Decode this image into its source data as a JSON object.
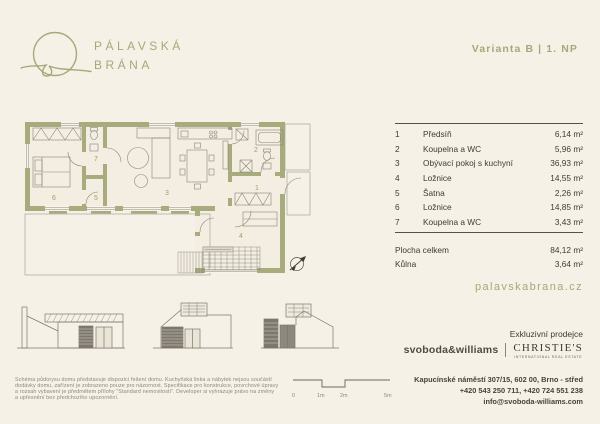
{
  "colors": {
    "background": "#f6f1e7",
    "olive_accent": "#a6a878",
    "wall_olive": "#a8ab7c",
    "ink": "#3e3b32",
    "muted_gray": "#8a857a"
  },
  "brand": {
    "line1": "PÁLAVSKÁ",
    "line2": "BRÁNA",
    "variant": "Varianta B | 1. NP",
    "website": "palavskabrana.cz"
  },
  "rooms": [
    {
      "num": "1",
      "label": "Předsíň",
      "area": "6,14 m²"
    },
    {
      "num": "2",
      "label": "Koupelna a WC",
      "area": "5,96 m²"
    },
    {
      "num": "3",
      "label": "Obývací pokoj s kuchyní",
      "area": "36,93 m²"
    },
    {
      "num": "4",
      "label": "Ložnice",
      "area": "14,55 m²"
    },
    {
      "num": "5",
      "label": "Šatna",
      "area": "2,26 m²"
    },
    {
      "num": "6",
      "label": "Ložnice",
      "area": "14,85 m²"
    },
    {
      "num": "7",
      "label": "Koupelna a WC",
      "area": "3,43 m²"
    }
  ],
  "totals": [
    {
      "label": "Plocha celkem",
      "area": "84,12 m²"
    },
    {
      "label": "Kůlna",
      "area": "3,64 m²"
    }
  ],
  "scalebar": {
    "t0": "0",
    "t1": "1m",
    "t2": "2m",
    "t5": "5m"
  },
  "disclaimer": {
    "line1": "Schéma půdorysu domu představuje dispozici řešení domu. Kuchyňská linka a nábytek nejsou součástí",
    "line2": "dodávky domu, zařízení je zobrazeno pouze pro názornost. Specifikace pro konstrukce, povrchové úpravy",
    "line3": "a rozsah vybavení je předmětem přílohy \"Standard nemovitosti\". Developer si vyhrazuje právo na změny",
    "line4": "a upřesnění bez předchozího upozornění."
  },
  "footer": {
    "exclusive": "Exkluzivní prodejce",
    "agency1": "svoboda&williams",
    "agency2": "CHRISTIE'S",
    "agency2_sub": "INTERNATIONAL REAL ESTATE",
    "address": "Kapucínské náměstí 307/15, 602 00, Brno - střed",
    "phones": "+420 543 250 711, +420 724 551 238",
    "email": "info@svoboda-williams.com"
  }
}
